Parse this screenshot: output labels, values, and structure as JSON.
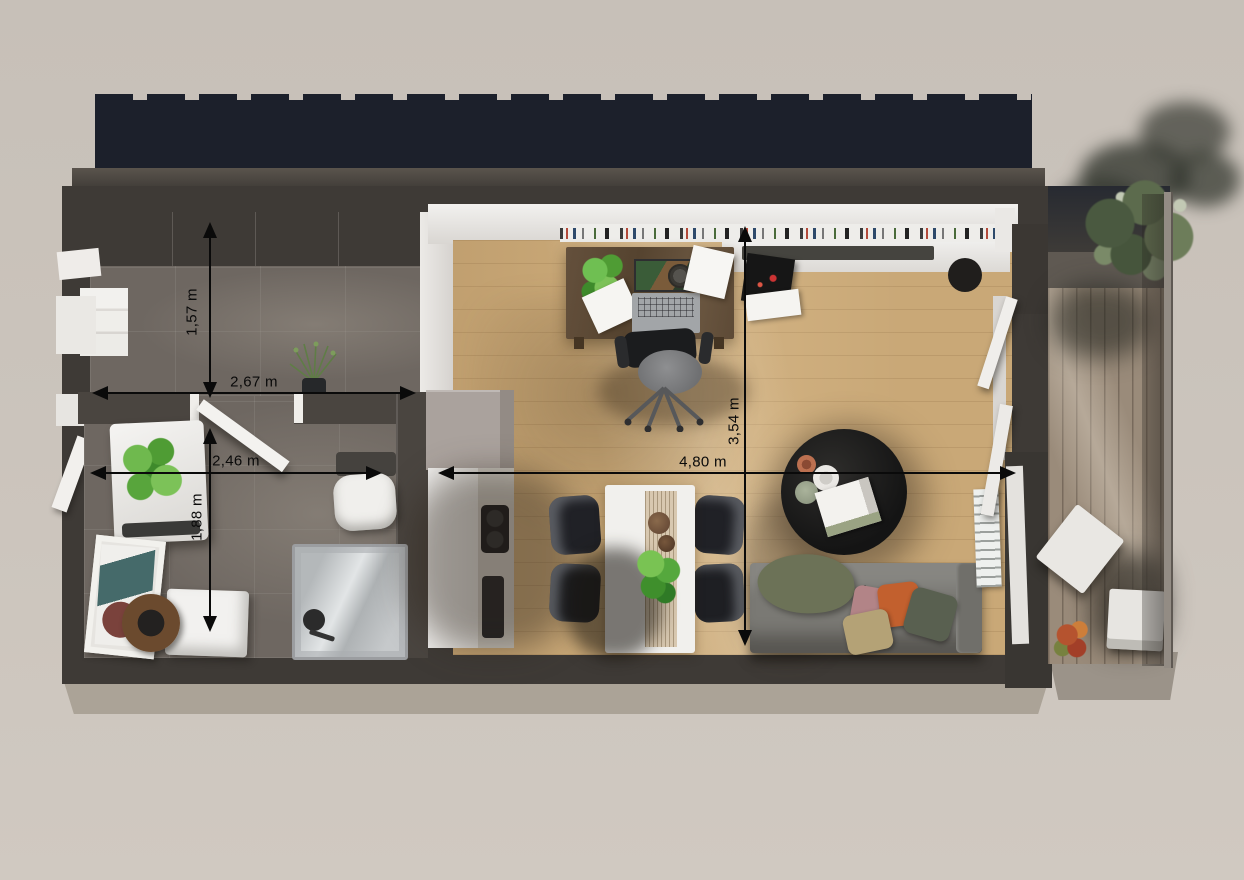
{
  "scene": {
    "type": "floor-plan-3d-render",
    "description": "Top-down 3D rendering of a small apartment with dimension arrows",
    "rooms_visible": [
      "hallway",
      "bathroom",
      "kitchen",
      "dining-area",
      "living-room",
      "home-office",
      "balcony"
    ]
  },
  "dimensions": [
    {
      "label": "1,57 m",
      "orientation": "vertical",
      "area": "hallway-depth"
    },
    {
      "label": "2,67 m",
      "orientation": "horizontal",
      "area": "hallway-width"
    },
    {
      "label": "2,46 m",
      "orientation": "horizontal",
      "area": "bathroom-width"
    },
    {
      "label": "1,88 m",
      "orientation": "vertical",
      "area": "bathroom-depth"
    },
    {
      "label": "3,54 m",
      "orientation": "vertical",
      "area": "living-room-depth"
    },
    {
      "label": "4,80 m",
      "orientation": "horizontal",
      "area": "living-room-width"
    }
  ],
  "colors": {
    "background": "#cbc4bc",
    "building_shadow": "#1c202b",
    "outer_wall": "#3e3a36",
    "interior_wall": "#4a4540",
    "wood_floor": "#c9a877",
    "tile_floor": "#6e6761",
    "deck": "#9a8b7a",
    "dimension": "#0a0a0a",
    "white_furniture": "#f0efec"
  }
}
